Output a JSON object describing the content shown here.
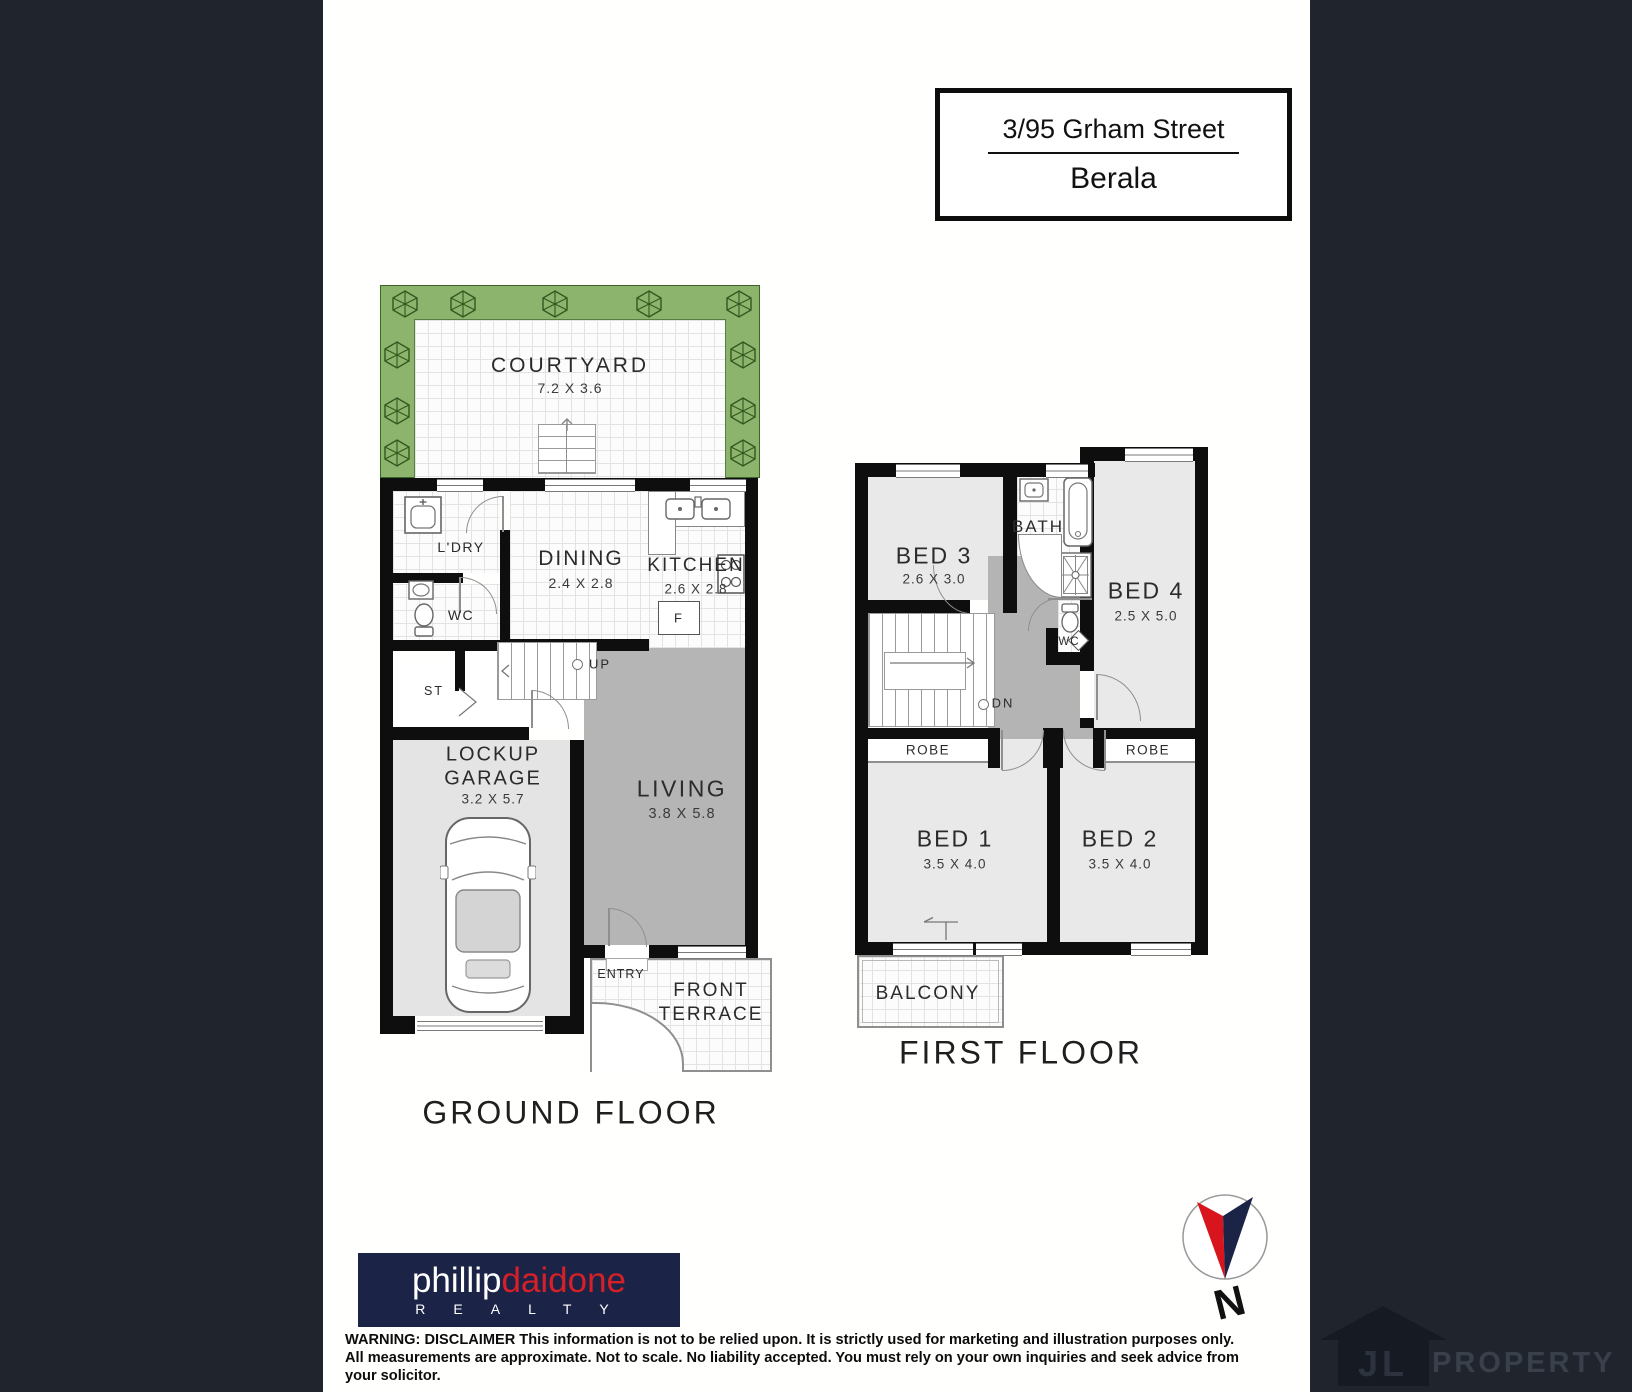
{
  "address": {
    "street": "3/95 Grham Street",
    "suburb": "Berala"
  },
  "ground_floor": {
    "title": "GROUND FLOOR",
    "courtyard": {
      "name": "COURTYARD",
      "dims": "7.2 X 3.6"
    },
    "laundry": {
      "name": "L'DRY"
    },
    "wc": {
      "name": "WC"
    },
    "dining": {
      "name": "DINING",
      "dims": "2.4 X 2.8"
    },
    "kitchen": {
      "name": "KITCHEN",
      "dims": "2.6 X 2.8"
    },
    "fridge": {
      "name": "F"
    },
    "store": {
      "name": "ST"
    },
    "stairs": {
      "name": "UP"
    },
    "living": {
      "name": "LIVING",
      "dims": "3.8 X 5.8"
    },
    "garage": {
      "name_line1": "LOCKUP",
      "name_line2": "GARAGE",
      "dims": "3.2 X 5.7"
    },
    "entry": {
      "name": "ENTRY"
    },
    "terrace": {
      "name_line1": "FRONT",
      "name_line2": "TERRACE"
    }
  },
  "first_floor": {
    "title": "FIRST FLOOR",
    "bed3": {
      "name": "BED 3",
      "dims": "2.6 X 3.0"
    },
    "bath": {
      "name": "BATH"
    },
    "bed4": {
      "name": "BED 4",
      "dims": "2.5 X 5.0"
    },
    "wc": {
      "name": "WC"
    },
    "stairs": {
      "name": "DN"
    },
    "robe_left": {
      "name": "ROBE"
    },
    "robe_right": {
      "name": "ROBE"
    },
    "bed1": {
      "name": "BED 1",
      "dims": "3.5 X 4.0"
    },
    "bed2": {
      "name": "BED 2",
      "dims": "3.5 X 4.0"
    },
    "balcony": {
      "name": "BALCONY"
    }
  },
  "agency": {
    "name_white": "phillip",
    "name_red": "daidone",
    "tagline": "REALTY",
    "navy": "#1b2347",
    "red": "#d52027"
  },
  "compass": {
    "label": "N"
  },
  "disclaimer": "WARNING: DISCLAIMER This information is not to be relied upon. It is strictly used for marketing and illustration purposes only. All measurements are approximate. Not to scale. No liability accepted. You must rely on your own inquiries and seek advice from your solicitor.",
  "watermark": {
    "initials": "JL",
    "name": "PROPERTY"
  }
}
